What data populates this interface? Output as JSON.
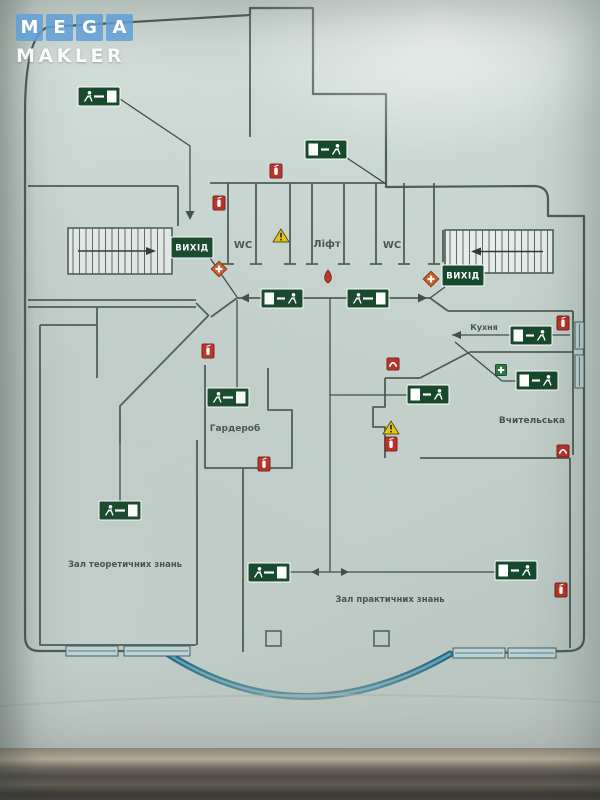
{
  "watermark": {
    "line1_letters": [
      "M",
      "E",
      "G",
      "A"
    ],
    "line2": "MAKLER",
    "tile_color": "#5fa0d7",
    "text_color": "#ffffff"
  },
  "plan": {
    "wall_color": "#4d5e57",
    "route_color": "#3f4f49",
    "exit_sign_bg": "#17492c",
    "glass_wall_color": "#2a6a80",
    "labels": [
      {
        "id": "wc-left",
        "text": "WC",
        "x": 243,
        "y": 248,
        "size": 10
      },
      {
        "id": "lift",
        "text": "Ліфт",
        "x": 327,
        "y": 247,
        "size": 10
      },
      {
        "id": "wc-right",
        "text": "WC",
        "x": 392,
        "y": 248,
        "size": 10
      },
      {
        "id": "kitchen",
        "text": "Кухня",
        "x": 484,
        "y": 330,
        "size": 8
      },
      {
        "id": "cloakroom",
        "text": "Гардероб",
        "x": 235,
        "y": 431,
        "size": 9
      },
      {
        "id": "teachers-room",
        "text": "Вчительська",
        "x": 532,
        "y": 423,
        "size": 9
      },
      {
        "id": "theory-hall",
        "text": "Зал теоретичних знань",
        "x": 125,
        "y": 567,
        "size": 8.5
      },
      {
        "id": "practice-hall",
        "text": "Зал практичних знань",
        "x": 390,
        "y": 602,
        "size": 8.5
      }
    ],
    "exit_banners": [
      {
        "text": "ВИХІД",
        "x": 171,
        "y": 237,
        "w": 42,
        "h": 21
      },
      {
        "text": "ВИХІД",
        "x": 442,
        "y": 265,
        "w": 42,
        "h": 21
      }
    ],
    "exit_signs": [
      {
        "x": 78,
        "y": 87,
        "door": "right"
      },
      {
        "x": 305,
        "y": 140,
        "door": "left"
      },
      {
        "x": 261,
        "y": 289,
        "door": "left"
      },
      {
        "x": 347,
        "y": 289,
        "door": "right"
      },
      {
        "x": 207,
        "y": 388,
        "door": "right"
      },
      {
        "x": 99,
        "y": 501,
        "door": "right"
      },
      {
        "x": 510,
        "y": 326,
        "door": "left"
      },
      {
        "x": 516,
        "y": 371,
        "door": "left"
      },
      {
        "x": 407,
        "y": 385,
        "door": "left"
      },
      {
        "x": 248,
        "y": 563,
        "door": "right"
      },
      {
        "x": 495,
        "y": 561,
        "door": "left"
      }
    ],
    "icons": [
      {
        "type": "fire-extinguisher",
        "x": 219,
        "y": 203
      },
      {
        "type": "fire-extinguisher",
        "x": 276,
        "y": 171
      },
      {
        "type": "fire-extinguisher",
        "x": 208,
        "y": 351
      },
      {
        "type": "fire-extinguisher",
        "x": 264,
        "y": 464
      },
      {
        "type": "fire-extinguisher",
        "x": 563,
        "y": 323
      },
      {
        "type": "fire-extinguisher",
        "x": 391,
        "y": 444
      },
      {
        "type": "fire-extinguisher",
        "x": 561,
        "y": 590
      },
      {
        "type": "emergency-phone",
        "x": 393,
        "y": 364
      },
      {
        "type": "emergency-phone",
        "x": 563,
        "y": 451
      },
      {
        "type": "hazard-triangle",
        "x": 281,
        "y": 236
      },
      {
        "type": "hazard-triangle",
        "x": 391,
        "y": 428
      },
      {
        "type": "first-aid-diamond",
        "x": 219,
        "y": 269
      },
      {
        "type": "first-aid-diamond",
        "x": 431,
        "y": 279
      },
      {
        "type": "first-aid-kit",
        "x": 501,
        "y": 370
      },
      {
        "type": "fire-hydrant-drop",
        "x": 328,
        "y": 277
      }
    ],
    "stairs": [
      {
        "x": 68,
        "y": 228,
        "w": 104,
        "h": 46,
        "dir": "right"
      },
      {
        "x": 445,
        "y": 230,
        "w": 108,
        "h": 43,
        "dir": "left"
      }
    ],
    "columns": [
      {
        "x": 266,
        "y": 631,
        "s": 15
      },
      {
        "x": 374,
        "y": 631,
        "s": 15
      }
    ],
    "windows": [
      {
        "x": 66,
        "y": 646,
        "w": 52,
        "h": 10,
        "o": "h"
      },
      {
        "x": 124,
        "y": 646,
        "w": 66,
        "h": 10,
        "o": "h"
      },
      {
        "x": 453,
        "y": 648,
        "w": 52,
        "h": 10,
        "o": "h"
      },
      {
        "x": 508,
        "y": 648,
        "w": 48,
        "h": 10,
        "o": "h"
      },
      {
        "x": 575,
        "y": 322,
        "w": 9,
        "h": 27,
        "o": "v"
      },
      {
        "x": 575,
        "y": 355,
        "w": 9,
        "h": 33,
        "o": "v"
      }
    ]
  }
}
